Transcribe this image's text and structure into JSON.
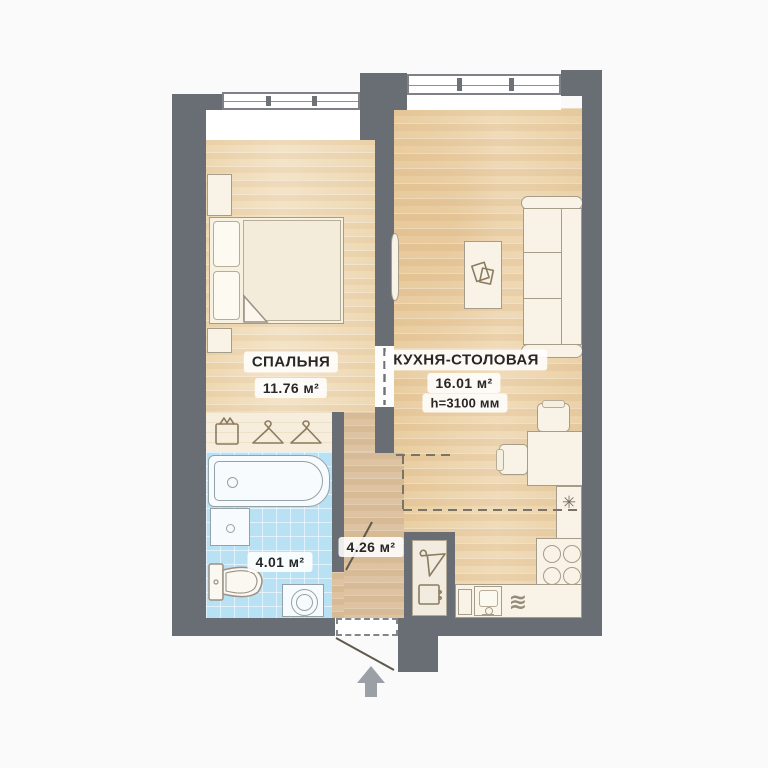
{
  "plan": {
    "type": "apartment-floor-plan",
    "rooms": {
      "bedroom": {
        "name": "СПАЛЬНЯ",
        "area": "11.76 м²"
      },
      "kitchen": {
        "name": "КУХНЯ-СТОЛОВАЯ",
        "area": "16.01 м²",
        "height_note": "h=3100 мм"
      },
      "bathroom": {
        "area": "4.01 м²"
      },
      "hallway": {
        "area": "4.26 м²"
      }
    },
    "symbols": {
      "burner": "✳",
      "dishwasher": "≋"
    },
    "icons": [
      "storage-box-icon",
      "hanger-icon",
      "hanger-icon",
      "hanger-icon",
      "storage-box-icon",
      "books-icon",
      "entrance-arrow-icon"
    ],
    "fixtures": [
      "bed",
      "nightstand",
      "nightstand",
      "wardrobe-strip",
      "bathtub",
      "vanity-sink",
      "toilet",
      "washing-machine",
      "tv",
      "coffee-table",
      "sofa",
      "dining-table",
      "chair",
      "chair",
      "counter",
      "stove",
      "kitchen-sink",
      "dishwasher",
      "hall-closet"
    ],
    "colors": {
      "wall": "#696d74",
      "background": "#fafafa",
      "wood_bedroom": "#f2e1c3",
      "wood_kitchen": "#eed7b3",
      "wood_hall": "#ddc3a1",
      "closet_strip": "#f6eddc",
      "bath_tile": "#b9e1f4",
      "fixture_outline": "#a59c89",
      "label_text": "#272727",
      "arrow": "#9aa0a6"
    }
  }
}
